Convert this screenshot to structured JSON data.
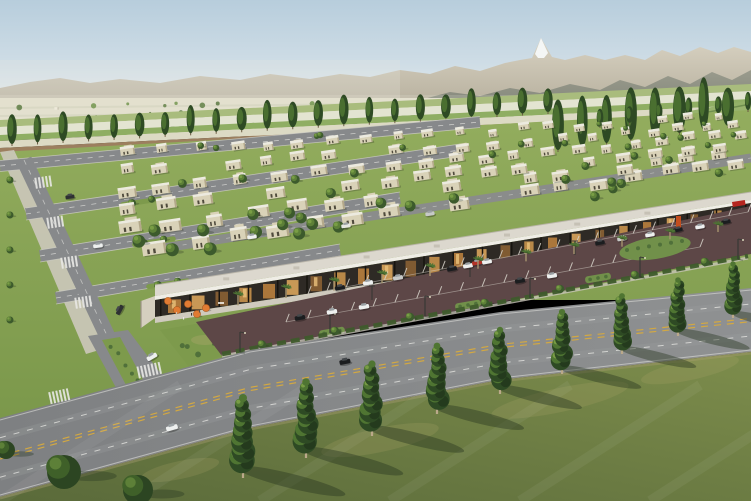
{
  "scene": {
    "description": "Aerial architectural rendering of a master-planned desert residential community: rows of flat-roof houses, a retail strip with parking lot, a curving tree-lined boulevard, farmland and mountains on the horizon",
    "width": 751,
    "height": 501
  },
  "palette": {
    "sky_top": "#b7cddc",
    "sky_mid": "#cfdde6",
    "sky_horizon": "#edf0ee",
    "mtn_far_top": "#d8d2c2",
    "mtn_far_bot": "#b7b09e",
    "mtn_near_top": "#97998b",
    "mtn_near_bot": "#7f8377",
    "snow": "#f4f6f5",
    "valley": "#e0ddca",
    "valley_line": "#c9cbb4",
    "field_green": "#8fae63",
    "field_green2": "#a9bc7d",
    "field_pale": "#e3e4d1",
    "field_pale2": "#dcdac4",
    "dirt": "#9c7f5f",
    "meadow": "#93b168",
    "meadow_line": "#aec584",
    "hedge_line": "#5f7f42",
    "lawn_top": "#93ad5e",
    "lawn_bot": "#7a974a",
    "tree_dark": "#2e4a24",
    "tree_mid": "#4f7532",
    "tree_light": "#7ca147",
    "tree_lit": "#5d8038",
    "trunk": "#bba98a",
    "trunk_dark": "#6b5b43",
    "wall": "#d9d2b8",
    "wall_shade": "#b3a88a",
    "roof_light": "#eceadf",
    "window_dark": "#4f4a3c",
    "street": "#87898b",
    "curb": "#cfcec6",
    "white_mark": "#e8e8e4",
    "road_light": "#8f9192",
    "road_dark": "#7e8082",
    "yellow": "#d2a843",
    "strip_roof": "#dcd8ce",
    "fascia": "#efede6",
    "storefront": "#2e2a25",
    "glow1": "#b97f3e",
    "glow2": "#d9a45c",
    "glow3": "#8a6134",
    "glow4": "#c8924d",
    "sidewalk": "#cfcabe",
    "parking": "#5d4747",
    "stall": "#d8d4cb",
    "umbrella": "#e07b33",
    "umbrella_edge": "#a85a20",
    "palm": "#4e7434",
    "palm_dark": "#3f5f2a",
    "palm_trunk": "#a6946f",
    "island_green": "#71904a",
    "shrub": "#50703a",
    "sculpture": "#c24e1e",
    "sign_red": "#b5261f",
    "fg_top": "#7d8d4c",
    "fg_bot": "#5a6a3a",
    "shadow": "#263420",
    "pole": "#3a3a36",
    "car_white": "#eef0ef",
    "car_black": "#1b1d1f",
    "car_silver": "#c7c9c8",
    "car_red": "#b23227",
    "car_dark": "#2e3032"
  },
  "mountains": {
    "far": [
      [
        0,
        88
      ],
      [
        30,
        82
      ],
      [
        60,
        78
      ],
      [
        90,
        83
      ],
      [
        120,
        79
      ],
      [
        160,
        83
      ],
      [
        200,
        76
      ],
      [
        240,
        80
      ],
      [
        270,
        74
      ],
      [
        310,
        79
      ],
      [
        340,
        74
      ],
      [
        370,
        77
      ],
      [
        400,
        70
      ],
      [
        430,
        74
      ],
      [
        455,
        66
      ],
      [
        480,
        71
      ],
      [
        505,
        63
      ],
      [
        520,
        60
      ],
      [
        532,
        58
      ],
      [
        541,
        38
      ],
      [
        552,
        57
      ],
      [
        565,
        60
      ],
      [
        585,
        55
      ],
      [
        605,
        60
      ],
      [
        625,
        55
      ],
      [
        645,
        60
      ],
      [
        662,
        50
      ],
      [
        680,
        56
      ],
      [
        700,
        47
      ],
      [
        718,
        53
      ],
      [
        734,
        47
      ],
      [
        751,
        52
      ]
    ],
    "near": [
      [
        420,
        100
      ],
      [
        450,
        92
      ],
      [
        480,
        96
      ],
      [
        510,
        88
      ],
      [
        540,
        93
      ],
      [
        570,
        84
      ],
      [
        600,
        90
      ],
      [
        620,
        80
      ],
      [
        645,
        87
      ],
      [
        668,
        76
      ],
      [
        690,
        84
      ],
      [
        712,
        72
      ],
      [
        732,
        80
      ],
      [
        751,
        70
      ]
    ],
    "snow": [
      [
        535,
        54
      ],
      [
        541,
        38
      ],
      [
        548,
        53
      ],
      [
        544,
        58
      ],
      [
        538,
        58
      ]
    ]
  },
  "farm": {
    "stripes": [
      {
        "y": 120,
        "h": 7,
        "c": "#a9bc7d"
      },
      {
        "y": 127,
        "h": 8,
        "c": "#e3e4d1"
      },
      {
        "y": 135,
        "h": 6,
        "c": "#8fae63"
      },
      {
        "y": 141,
        "h": 7,
        "c": "#dcdac4"
      },
      {
        "y": 148,
        "h": 7,
        "c": "#9c7f5f"
      }
    ],
    "meadow": [
      [
        555,
        135
      ],
      [
        751,
        100
      ],
      [
        751,
        175
      ],
      [
        700,
        185
      ],
      [
        555,
        172
      ]
    ],
    "scatter_count": 62,
    "building_count": 8
  },
  "poplar_rows": [
    {
      "x0": 12,
      "y0": 144,
      "x1": 548,
      "y1": 112,
      "n": 22,
      "rx": 4.5,
      "ry": 13
    },
    {
      "x0": 558,
      "y0": 150,
      "x1": 728,
      "y1": 126,
      "n": 8,
      "rx": 6,
      "ry": 22
    },
    {
      "x0": 600,
      "y0": 126,
      "x1": 748,
      "y1": 110,
      "n": 6,
      "rx": 3.5,
      "ry": 9
    }
  ],
  "housing": {
    "bottom": [
      150,
      262,
      751,
      168
    ],
    "top": [
      0,
      148,
      751,
      110
    ],
    "rows": 6,
    "tree_count": 46
  },
  "streets": [
    [
      0,
      166,
      480,
      122,
      11
    ],
    [
      26,
      214,
      460,
      150,
      12
    ],
    [
      40,
      256,
      400,
      198,
      12
    ],
    [
      56,
      298,
      340,
      250,
      12
    ]
  ],
  "collector": [
    24,
    160,
    112,
    346,
    16
  ],
  "back_street": [
    150,
    250,
    751,
    158,
    9
  ],
  "branch": {
    "road": [
      [
        88,
        336
      ],
      [
        128,
        330
      ],
      [
        196,
        420
      ],
      [
        140,
        432
      ]
    ],
    "island": [
      [
        102,
        340
      ],
      [
        120,
        337
      ],
      [
        152,
        396
      ],
      [
        134,
        400
      ]
    ],
    "corner_garden": [
      [
        160,
        330
      ],
      [
        230,
        318
      ],
      [
        250,
        345
      ],
      [
        190,
        368
      ]
    ]
  },
  "zebras": [
    {
      "x": 44,
      "y": 182,
      "a": -8.5,
      "n": 5,
      "len": 11
    },
    {
      "x": 56,
      "y": 222,
      "a": -8.5,
      "n": 5,
      "len": 11
    },
    {
      "x": 70,
      "y": 262,
      "a": -8.5,
      "n": 5,
      "len": 11
    },
    {
      "x": 84,
      "y": 302,
      "a": -8.5,
      "n": 5,
      "len": 11
    },
    {
      "x": 150,
      "y": 370,
      "a": -12,
      "n": 7,
      "len": 12
    },
    {
      "x": 60,
      "y": 396,
      "a": -12,
      "n": 6,
      "len": 12
    }
  ],
  "strip": {
    "roof_back": [
      155,
      285,
      751,
      192
    ],
    "fascia_top": [
      155,
      296,
      751,
      200
    ],
    "fascia_bot": [
      155,
      300,
      751,
      203
    ],
    "base": [
      155,
      317,
      751,
      226
    ],
    "walk_bot": [
      155,
      323,
      751,
      231
    ],
    "end_cap": [
      [
        141,
        301
      ],
      [
        155,
        296
      ],
      [
        155,
        318
      ],
      [
        141,
        328
      ]
    ],
    "window_count": 24,
    "column_count": 21,
    "roof_unit_count": 7
  },
  "parking": {
    "poly": [
      [
        196,
        322
      ],
      [
        751,
        206
      ],
      [
        751,
        254
      ],
      [
        222,
        356
      ]
    ],
    "stall_rows": [
      [
        308,
        294,
        748,
        212,
        24
      ],
      [
        286,
        322,
        700,
        247,
        20
      ]
    ]
  },
  "hedge": [
    222,
    356,
    748,
    258
  ],
  "hedge_trees": [
    262,
    335,
    410,
    485,
    560,
    635,
    705
  ],
  "islands": [
    [
      332,
      332
    ],
    [
      468,
      305
    ],
    [
      598,
      278
    ]
  ],
  "right_island": {
    "cx": 655,
    "cy": 248,
    "rx": 36,
    "ry": 11,
    "sculpture": [
      676,
      216,
      5,
      15
    ],
    "sign": [
      732,
      202,
      13,
      5
    ]
  },
  "road": {
    "upper": [
      [
        0,
        418
      ],
      [
        250,
        350
      ],
      [
        500,
        312
      ],
      [
        751,
        288
      ]
    ],
    "lower": [
      [
        0,
        497
      ],
      [
        250,
        428
      ],
      [
        500,
        380
      ],
      [
        751,
        352
      ]
    ]
  },
  "poles": [
    [
      240,
      352
    ],
    [
      330,
      333
    ],
    [
      425,
      316
    ],
    [
      530,
      298
    ],
    [
      640,
      277
    ],
    [
      738,
      259
    ]
  ],
  "lot_lamps": [
    [
      372,
      300
    ],
    [
      470,
      277
    ],
    [
      575,
      255
    ]
  ],
  "cars": [
    {
      "x": 70,
      "y": 197,
      "c": "#2e3032",
      "a": -8
    },
    {
      "x": 98,
      "y": 246,
      "c": "#eef0ef",
      "a": -8
    },
    {
      "x": 120,
      "y": 310,
      "c": "#2e3032",
      "a": -62
    },
    {
      "x": 152,
      "y": 357,
      "c": "#eef0ef",
      "a": -30
    },
    {
      "x": 252,
      "y": 237,
      "c": "#eef0ef",
      "a": -9
    },
    {
      "x": 346,
      "y": 226,
      "c": "#e6e6e2",
      "a": -9
    },
    {
      "x": 430,
      "y": 214,
      "c": "#c7c9c8",
      "a": -9
    },
    {
      "x": 340,
      "y": 288,
      "c": "#1b1d1f",
      "a": -10
    },
    {
      "x": 368,
      "y": 283,
      "c": "#eef0ef",
      "a": -10
    },
    {
      "x": 398,
      "y": 278,
      "c": "#c7c9c8",
      "a": -10
    },
    {
      "x": 452,
      "y": 269,
      "c": "#1b1d1f",
      "a": -10
    },
    {
      "x": 468,
      "y": 266,
      "c": "#eef0ef",
      "a": -10
    },
    {
      "x": 477,
      "y": 263,
      "c": "#b23227",
      "a": -10
    },
    {
      "x": 487,
      "y": 262,
      "c": "#eef0ef",
      "a": -10
    },
    {
      "x": 600,
      "y": 243,
      "c": "#1b1d1f",
      "a": -10
    },
    {
      "x": 622,
      "y": 239,
      "c": "#c7c9c8",
      "a": -10
    },
    {
      "x": 650,
      "y": 235,
      "c": "#eef0ef",
      "a": -10
    },
    {
      "x": 678,
      "y": 230,
      "c": "#1b1d1f",
      "a": -10
    },
    {
      "x": 700,
      "y": 227,
      "c": "#eef0ef",
      "a": -10
    },
    {
      "x": 726,
      "y": 222,
      "c": "#1b1d1f",
      "a": -10
    },
    {
      "x": 300,
      "y": 318,
      "c": "#1b1d1f",
      "a": -10
    },
    {
      "x": 332,
      "y": 312,
      "c": "#eef0ef",
      "a": -10
    },
    {
      "x": 364,
      "y": 307,
      "c": "#eef0ef",
      "a": -10
    },
    {
      "x": 520,
      "y": 281,
      "c": "#1b1d1f",
      "a": -10
    },
    {
      "x": 552,
      "y": 276,
      "c": "#eef0ef",
      "a": -10
    },
    {
      "x": 172,
      "y": 428,
      "c": "#eef0ef",
      "a": -17
    },
    {
      "x": 345,
      "y": 362,
      "c": "#1b1d1f",
      "a": -11
    }
  ],
  "umbrellas": [
    [
      168,
      301
    ],
    [
      177,
      310
    ],
    [
      188,
      304
    ],
    [
      197,
      314
    ],
    [
      206,
      308
    ]
  ],
  "people": [
    [
      183,
      317
    ],
    [
      191,
      313
    ],
    [
      176,
      312
    ],
    [
      199,
      310
    ]
  ],
  "palms": {
    "x0": 238,
    "x1": 718,
    "n": 11
  },
  "foreground": {
    "poly": [
      [
        0,
        497
      ],
      [
        250,
        428
      ],
      [
        500,
        380
      ],
      [
        751,
        352
      ],
      [
        751,
        501
      ],
      [
        0,
        501
      ]
    ],
    "poplars": [
      [
        243,
        478,
        80
      ],
      [
        306,
        458,
        76
      ],
      [
        372,
        436,
        72
      ],
      [
        437,
        414,
        68
      ],
      [
        500,
        394,
        64
      ],
      [
        562,
        374,
        62
      ],
      [
        622,
        354,
        58
      ],
      [
        678,
        336,
        56
      ],
      [
        733,
        318,
        54
      ]
    ],
    "corner_trees": [
      [
        64,
        472,
        17
      ],
      [
        138,
        490,
        15
      ],
      [
        6,
        450,
        9
      ]
    ],
    "patches": [
      [
        380,
        440,
        60,
        12
      ],
      [
        560,
        400,
        70,
        12
      ],
      [
        180,
        470,
        40,
        9
      ],
      [
        690,
        370,
        50,
        10
      ]
    ]
  }
}
